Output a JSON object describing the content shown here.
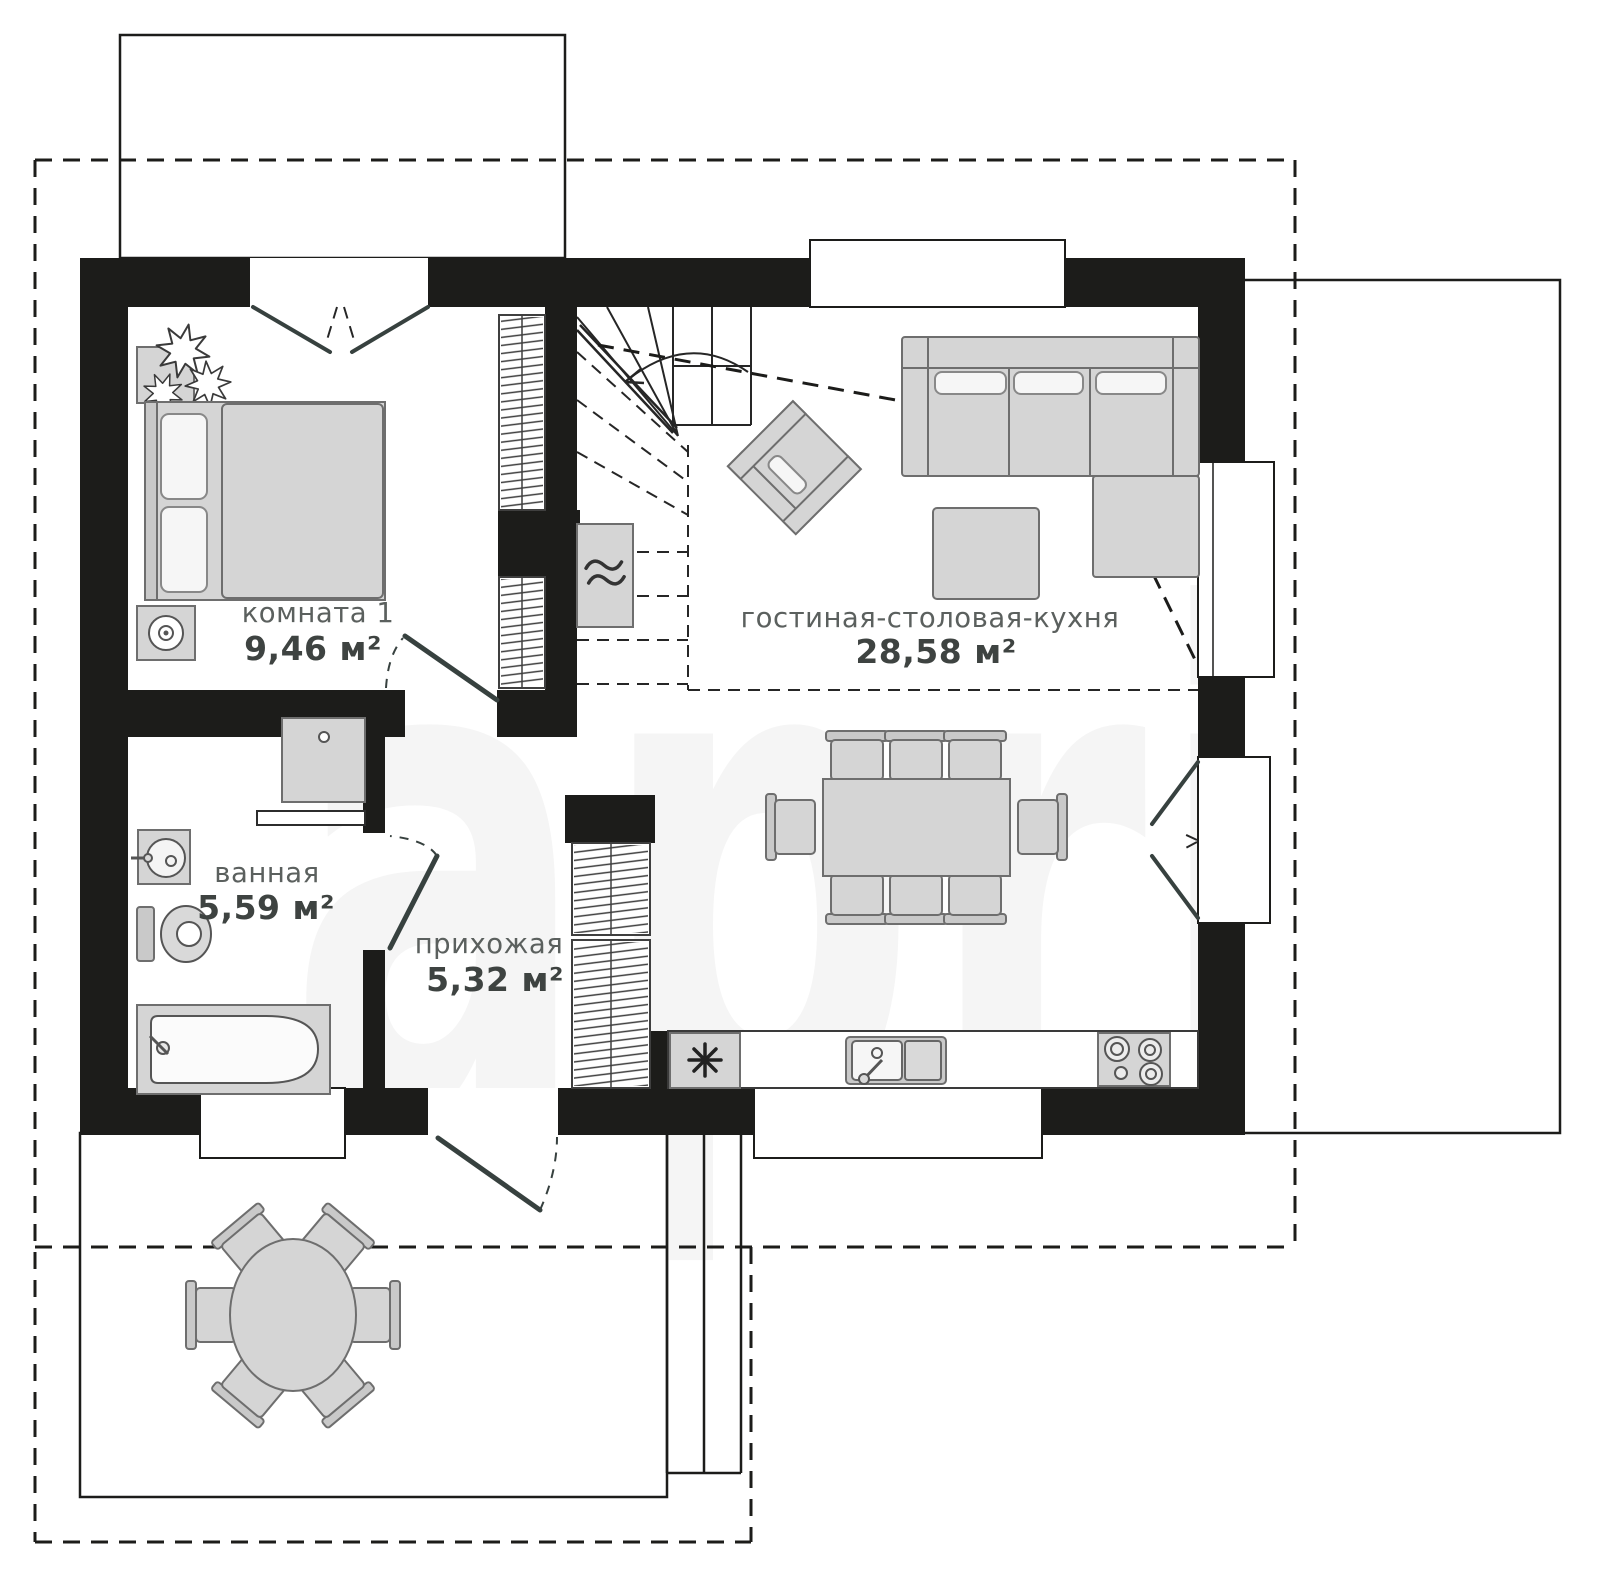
{
  "watermark": "april",
  "rooms": [
    {
      "name": "комната 1",
      "area": "9,46 м²"
    },
    {
      "name": "гостиная-столовая-кухня",
      "area": "28,58 м²"
    },
    {
      "name": "ванная",
      "area": "5,59 м²"
    },
    {
      "name": "прихожая",
      "area": "5,32 м²"
    }
  ],
  "colors": {
    "wall": "#1c1c1a",
    "furniture_fill": "#d5d5d5",
    "furniture_stroke": "#6e6e6e",
    "label_name": "#5b605e",
    "label_area": "#3e4341",
    "watermark": "#f5f5f5",
    "background": "#ffffff"
  }
}
